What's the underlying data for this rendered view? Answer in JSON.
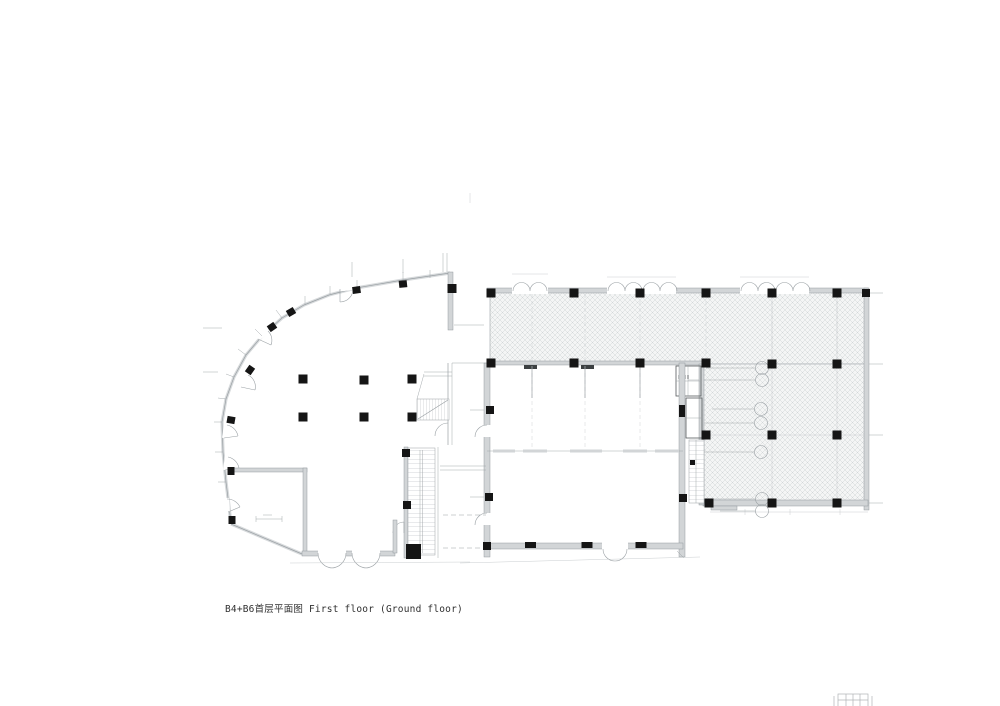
{
  "window": {
    "background": "#ffffff"
  },
  "caption": {
    "text": "B4+B6首层平面图 First floor (Ground floor)"
  },
  "plan": {
    "name": "B4+B6 ground floor plan drawing",
    "colors": {
      "line": "#9aa0a4",
      "line_light": "#c4c8cb",
      "wall_body": "#d7dadc",
      "wall_fill": "#d2d5d7",
      "wall_edge": "#8f959a",
      "column": "#151515",
      "hatch_line": "#d2d6d8",
      "hatch_bg": "#f4f5f5",
      "text": "#2f2f2f"
    }
  }
}
